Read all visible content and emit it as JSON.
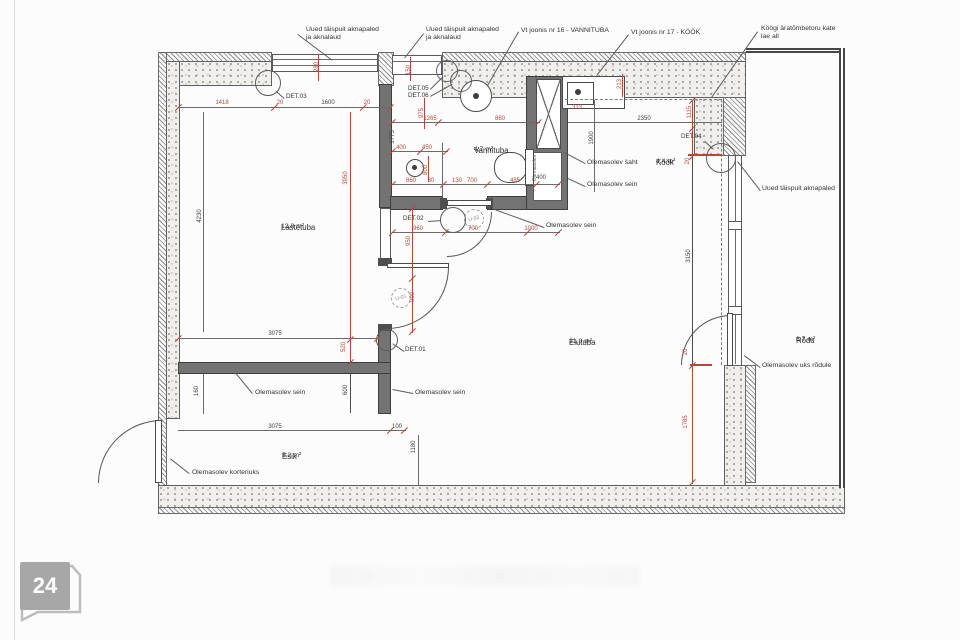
{
  "page_badge": "24",
  "rooms": {
    "lastetuba": {
      "name": "Lastetuba",
      "area": "12,8 m²"
    },
    "vannituba": {
      "name": "Vannituba",
      "area": "4,7 m²"
    },
    "kook": {
      "name": "Köök",
      "area": "4,4 m²"
    },
    "elutuba": {
      "name": "Elutuba",
      "area": "21,0 m²"
    },
    "esik": {
      "name": "Esik",
      "area": "5,2 m²"
    },
    "rodu": {
      "name": "Rõdu",
      "area": "8,7 m²"
    }
  },
  "callouts": {
    "window_left_l1": "Uued täispuit aknapaled",
    "window_left_l2": "ja aknalaud",
    "window_mid_l1": "Uued täispuit aknapaled",
    "window_mid_l2": "ja aknalaud",
    "ref_vannituba": "Vt joonis nr 16 - VANNITUBA",
    "ref_kook": "Vt joonis nr 17 - KÖÖK",
    "hood_l1": "Köögi äratõmbetoru kate",
    "hood_l2": "lae all",
    "window_right": "Uued täispuit aknapaled",
    "balcony_door": "Olemasolev uks rõdule",
    "shaft": "Olemasolev šaht",
    "wall_shaft": "Olemasolev sein",
    "wall_bath": "Olemasolev sein",
    "wall_hall": "Olemasolev sein",
    "wall_esik": "Olemasolev sein",
    "entry_door": "Olemasolev korteriuks",
    "shaft_vertical": "Olemasolev"
  },
  "details": {
    "d1": "DET.01",
    "d2": "DET.02",
    "d3": "DET.03",
    "d4": "DET.04",
    "d5": "DET.05",
    "d6": "DET.06"
  },
  "doors": {
    "u1": "U-01",
    "u2": "U-02"
  },
  "colors": {
    "dim_red": "#b2493d",
    "ink": "#3c3c3c"
  },
  "dim_labels": [
    {
      "t": "1418",
      "x": 222,
      "y": 103,
      "v": 0,
      "c": "r"
    },
    {
      "t": "20",
      "x": 280,
      "y": 103,
      "v": 0,
      "c": "r"
    },
    {
      "t": "1600",
      "x": 328,
      "y": 103,
      "v": 0,
      "c": "b"
    },
    {
      "t": "20",
      "x": 367,
      "y": 103,
      "v": 0,
      "c": "r"
    },
    {
      "t": "280",
      "x": 317,
      "y": 67,
      "v": 1,
      "c": "r"
    },
    {
      "t": "150",
      "x": 409,
      "y": 70,
      "v": 1,
      "c": "r"
    },
    {
      "t": "975",
      "x": 422,
      "y": 113,
      "v": 1,
      "c": "r"
    },
    {
      "t": "1265",
      "x": 430,
      "y": 119,
      "v": 0,
      "c": "r"
    },
    {
      "t": "860",
      "x": 500,
      "y": 119,
      "v": 0,
      "c": "r"
    },
    {
      "t": "1775",
      "x": 393,
      "y": 137,
      "v": 1,
      "c": "b"
    },
    {
      "t": "400",
      "x": 401,
      "y": 148,
      "v": 0,
      "c": "r"
    },
    {
      "t": "450",
      "x": 427,
      "y": 148,
      "v": 0,
      "c": "r"
    },
    {
      "t": "800",
      "x": 426,
      "y": 170,
      "v": 1,
      "c": "r"
    },
    {
      "t": "860",
      "x": 411,
      "y": 181,
      "v": 0,
      "c": "r"
    },
    {
      "t": "30",
      "x": 431,
      "y": 181,
      "v": 0,
      "c": "r"
    },
    {
      "t": "130",
      "x": 457,
      "y": 181,
      "v": 0,
      "c": "r"
    },
    {
      "t": "700",
      "x": 472,
      "y": 181,
      "v": 0,
      "c": "r"
    },
    {
      "t": "485",
      "x": 515,
      "y": 181,
      "v": 0,
      "c": "r"
    },
    {
      "t": "400",
      "x": 541,
      "y": 178,
      "v": 0,
      "c": "b"
    },
    {
      "t": "960",
      "x": 418,
      "y": 229,
      "v": 0,
      "c": "r"
    },
    {
      "t": "700",
      "x": 473,
      "y": 229,
      "v": 0,
      "c": "r"
    },
    {
      "t": "1000",
      "x": 531,
      "y": 229,
      "v": 0,
      "c": "r"
    },
    {
      "t": "950",
      "x": 409,
      "y": 241,
      "v": 1,
      "c": "r"
    },
    {
      "t": "900",
      "x": 413,
      "y": 297,
      "v": 1,
      "c": "r"
    },
    {
      "t": "313",
      "x": 577,
      "y": 108,
      "v": 0,
      "c": "r"
    },
    {
      "t": "213",
      "x": 620,
      "y": 84,
      "v": 1,
      "c": "r"
    },
    {
      "t": "2350",
      "x": 644,
      "y": 119,
      "v": 0,
      "c": "b"
    },
    {
      "t": "1900",
      "x": 592,
      "y": 138,
      "v": 1,
      "c": "b"
    },
    {
      "t": "1115",
      "x": 690,
      "y": 112,
      "v": 1,
      "c": "r"
    },
    {
      "t": "20",
      "x": 688,
      "y": 161,
      "v": 1,
      "c": "r"
    },
    {
      "t": "3150",
      "x": 689,
      "y": 256,
      "v": 1,
      "c": "b"
    },
    {
      "t": "20",
      "x": 686,
      "y": 352,
      "v": 1,
      "c": "r"
    },
    {
      "t": "1785",
      "x": 686,
      "y": 422,
      "v": 1,
      "c": "r"
    },
    {
      "t": "4230",
      "x": 200,
      "y": 216,
      "v": 1,
      "c": "b"
    },
    {
      "t": "3950",
      "x": 346,
      "y": 178,
      "v": 1,
      "c": "r"
    },
    {
      "t": "3075",
      "x": 275,
      "y": 334,
      "v": 0,
      "c": "b"
    },
    {
      "t": "520",
      "x": 344,
      "y": 347,
      "v": 1,
      "c": "r"
    },
    {
      "t": "160",
      "x": 197,
      "y": 391,
      "v": 1,
      "c": "b"
    },
    {
      "t": "600",
      "x": 346,
      "y": 390,
      "v": 1,
      "c": "b"
    },
    {
      "t": "3075",
      "x": 275,
      "y": 427,
      "v": 0,
      "c": "b"
    },
    {
      "t": "100",
      "x": 397,
      "y": 427,
      "v": 0,
      "c": "b"
    },
    {
      "t": "1180",
      "x": 414,
      "y": 447,
      "v": 1,
      "c": "b"
    }
  ]
}
